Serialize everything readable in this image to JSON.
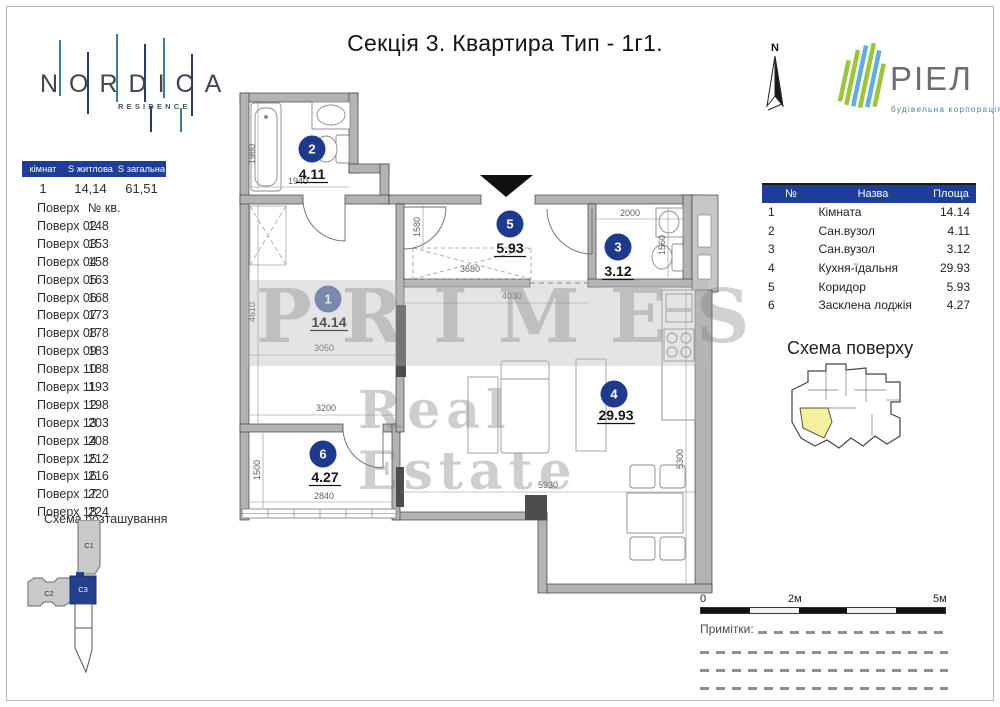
{
  "title": "Секція 3. Квартира Тип - 1г1.",
  "branding": {
    "nordica_name": "NORDICA",
    "nordica_sub": "RESIDENCE",
    "riel_name": "РІЕЛ",
    "riel_sub": "будівельна корпорація",
    "north_label": "N"
  },
  "left_panel": {
    "summary": {
      "headers": [
        "кімнат",
        "S житлова",
        "S загальна"
      ],
      "values": [
        "1",
        "14,14",
        "61,51"
      ]
    },
    "floors": {
      "headers": [
        "Поверх",
        "№ кв."
      ],
      "rows": [
        [
          "Поверх 02",
          "148"
        ],
        [
          "Поверх 03",
          "153"
        ],
        [
          "Поверх 04",
          "158"
        ],
        [
          "Поверх 05",
          "163"
        ],
        [
          "Поверх 06",
          "168"
        ],
        [
          "Поверх 07",
          "173"
        ],
        [
          "Поверх 08",
          "178"
        ],
        [
          "Поверх 09",
          "183"
        ],
        [
          "Поверх 10",
          "188"
        ],
        [
          "Поверх 11",
          "193"
        ],
        [
          "Поверх 12",
          "198"
        ],
        [
          "Поверх 13",
          "203"
        ],
        [
          "Поверх 14",
          "208"
        ],
        [
          "Поверх 15",
          "212"
        ],
        [
          "Поверх 16",
          "216"
        ],
        [
          "Поверх 17",
          "220"
        ],
        [
          "Поверх 18",
          "224"
        ]
      ]
    },
    "site_scheme_title": "Схема розташування",
    "buildings": {
      "c1": "C1",
      "c2": "C2",
      "c3": "C3",
      "highlighted": "C3"
    }
  },
  "rooms_table": {
    "headers": [
      "№",
      "Назва",
      "Площа"
    ],
    "rows": [
      [
        "1",
        "Кімната",
        "14.14"
      ],
      [
        "2",
        "Сан.вузол",
        "4.11"
      ],
      [
        "3",
        "Сан.вузол",
        "3.12"
      ],
      [
        "4",
        "Кухня-їдальня",
        "29.93"
      ],
      [
        "5",
        "Коридор",
        "5.93"
      ],
      [
        "6",
        "Засклена лоджія",
        "4.27"
      ]
    ]
  },
  "floor_scheme_title": "Схема поверху",
  "plan": {
    "rooms": {
      "r1": {
        "num": "1",
        "area": "14.14"
      },
      "r2": {
        "num": "2",
        "area": "4.11"
      },
      "r3": {
        "num": "3",
        "area": "3.12"
      },
      "r4": {
        "num": "4",
        "area": "29.93"
      },
      "r5": {
        "num": "5",
        "area": "5.93"
      },
      "r6": {
        "num": "6",
        "area": "4.27"
      }
    },
    "dims": {
      "bath_h": "1980",
      "bath_w": "1940",
      "hall": "1580",
      "wardrobe": "3680",
      "wc_w": "2000",
      "wc_h": "1560",
      "room1_h": "4610",
      "room1_w1": "3050",
      "room1_w2": "3200",
      "kitchen_top": "4030",
      "kitchen_w": "5930",
      "kitchen_h": "5300",
      "loggia_h": "1500",
      "loggia_w": "2840"
    }
  },
  "scale_bar": {
    "zero": "0",
    "mid": "2м",
    "end": "5м"
  },
  "notes_label": "Примітки:",
  "watermark": {
    "line1": "PRIMES",
    "line2": "Real Estate"
  },
  "colors": {
    "accent": "#1e3e96",
    "wall": "#b3b3b3",
    "highlight_yellow": "#f5ef9e"
  }
}
